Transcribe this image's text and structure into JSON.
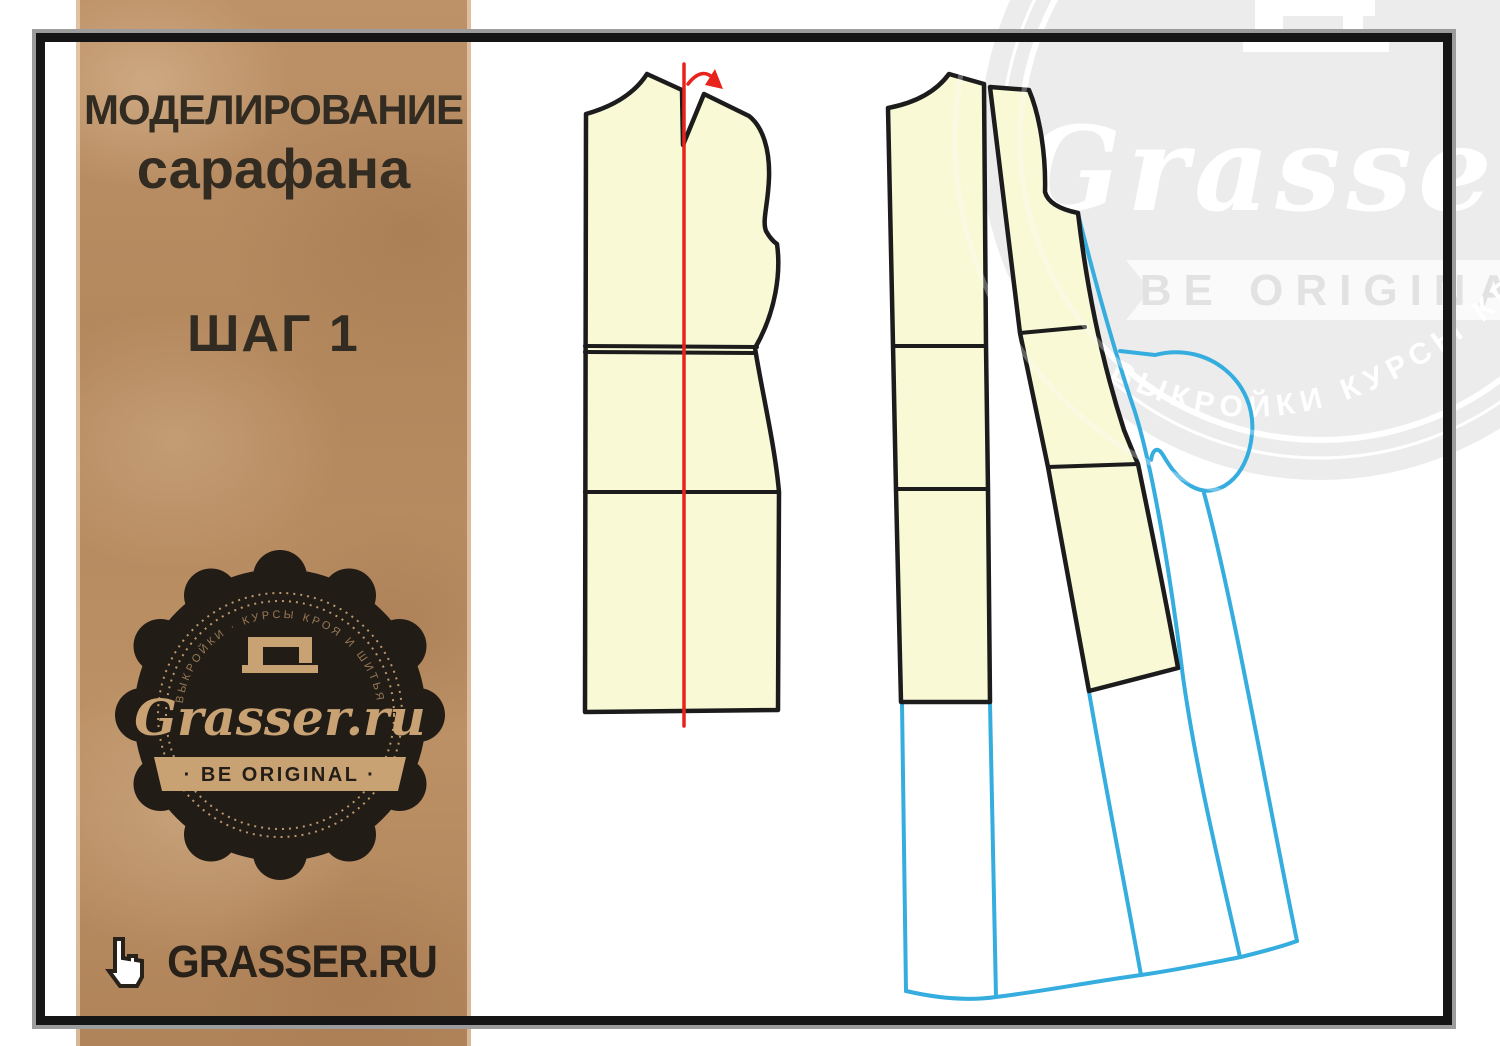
{
  "sidebar": {
    "title_line1": "МОДЕЛИРОВАНИЕ",
    "title_line2": "сарафана",
    "step_label": "ШАГ 1",
    "badge": {
      "brand": "Grasser.ru",
      "tagline": "· BE ORIGINAL ·",
      "arc_text": "ВЫКРОЙКИ · КУРСЫ КРОЯ И ШИТЬЯ"
    },
    "footer": {
      "site": "GRASSER.RU"
    }
  },
  "watermark": {
    "brand": "Grasser.",
    "tagline": "BE ORIGINAL",
    "arc_text": "ВЫКРОЙКИ КУРСЫ КРОЯ И ШИТЬЯ"
  },
  "colors": {
    "kraft": "#B78C62",
    "pattern_fill": "#F9F9D6",
    "pattern_outline": "#1C1C1C",
    "guide_red": "#E8231B",
    "model_blue": "#35ADDF",
    "badge_background": "#221C17",
    "badge_accent": "#C49A6C",
    "frame": "#151515",
    "frame_shadow": "#9C9C9C",
    "watermark_gray": "#ECECEC"
  }
}
